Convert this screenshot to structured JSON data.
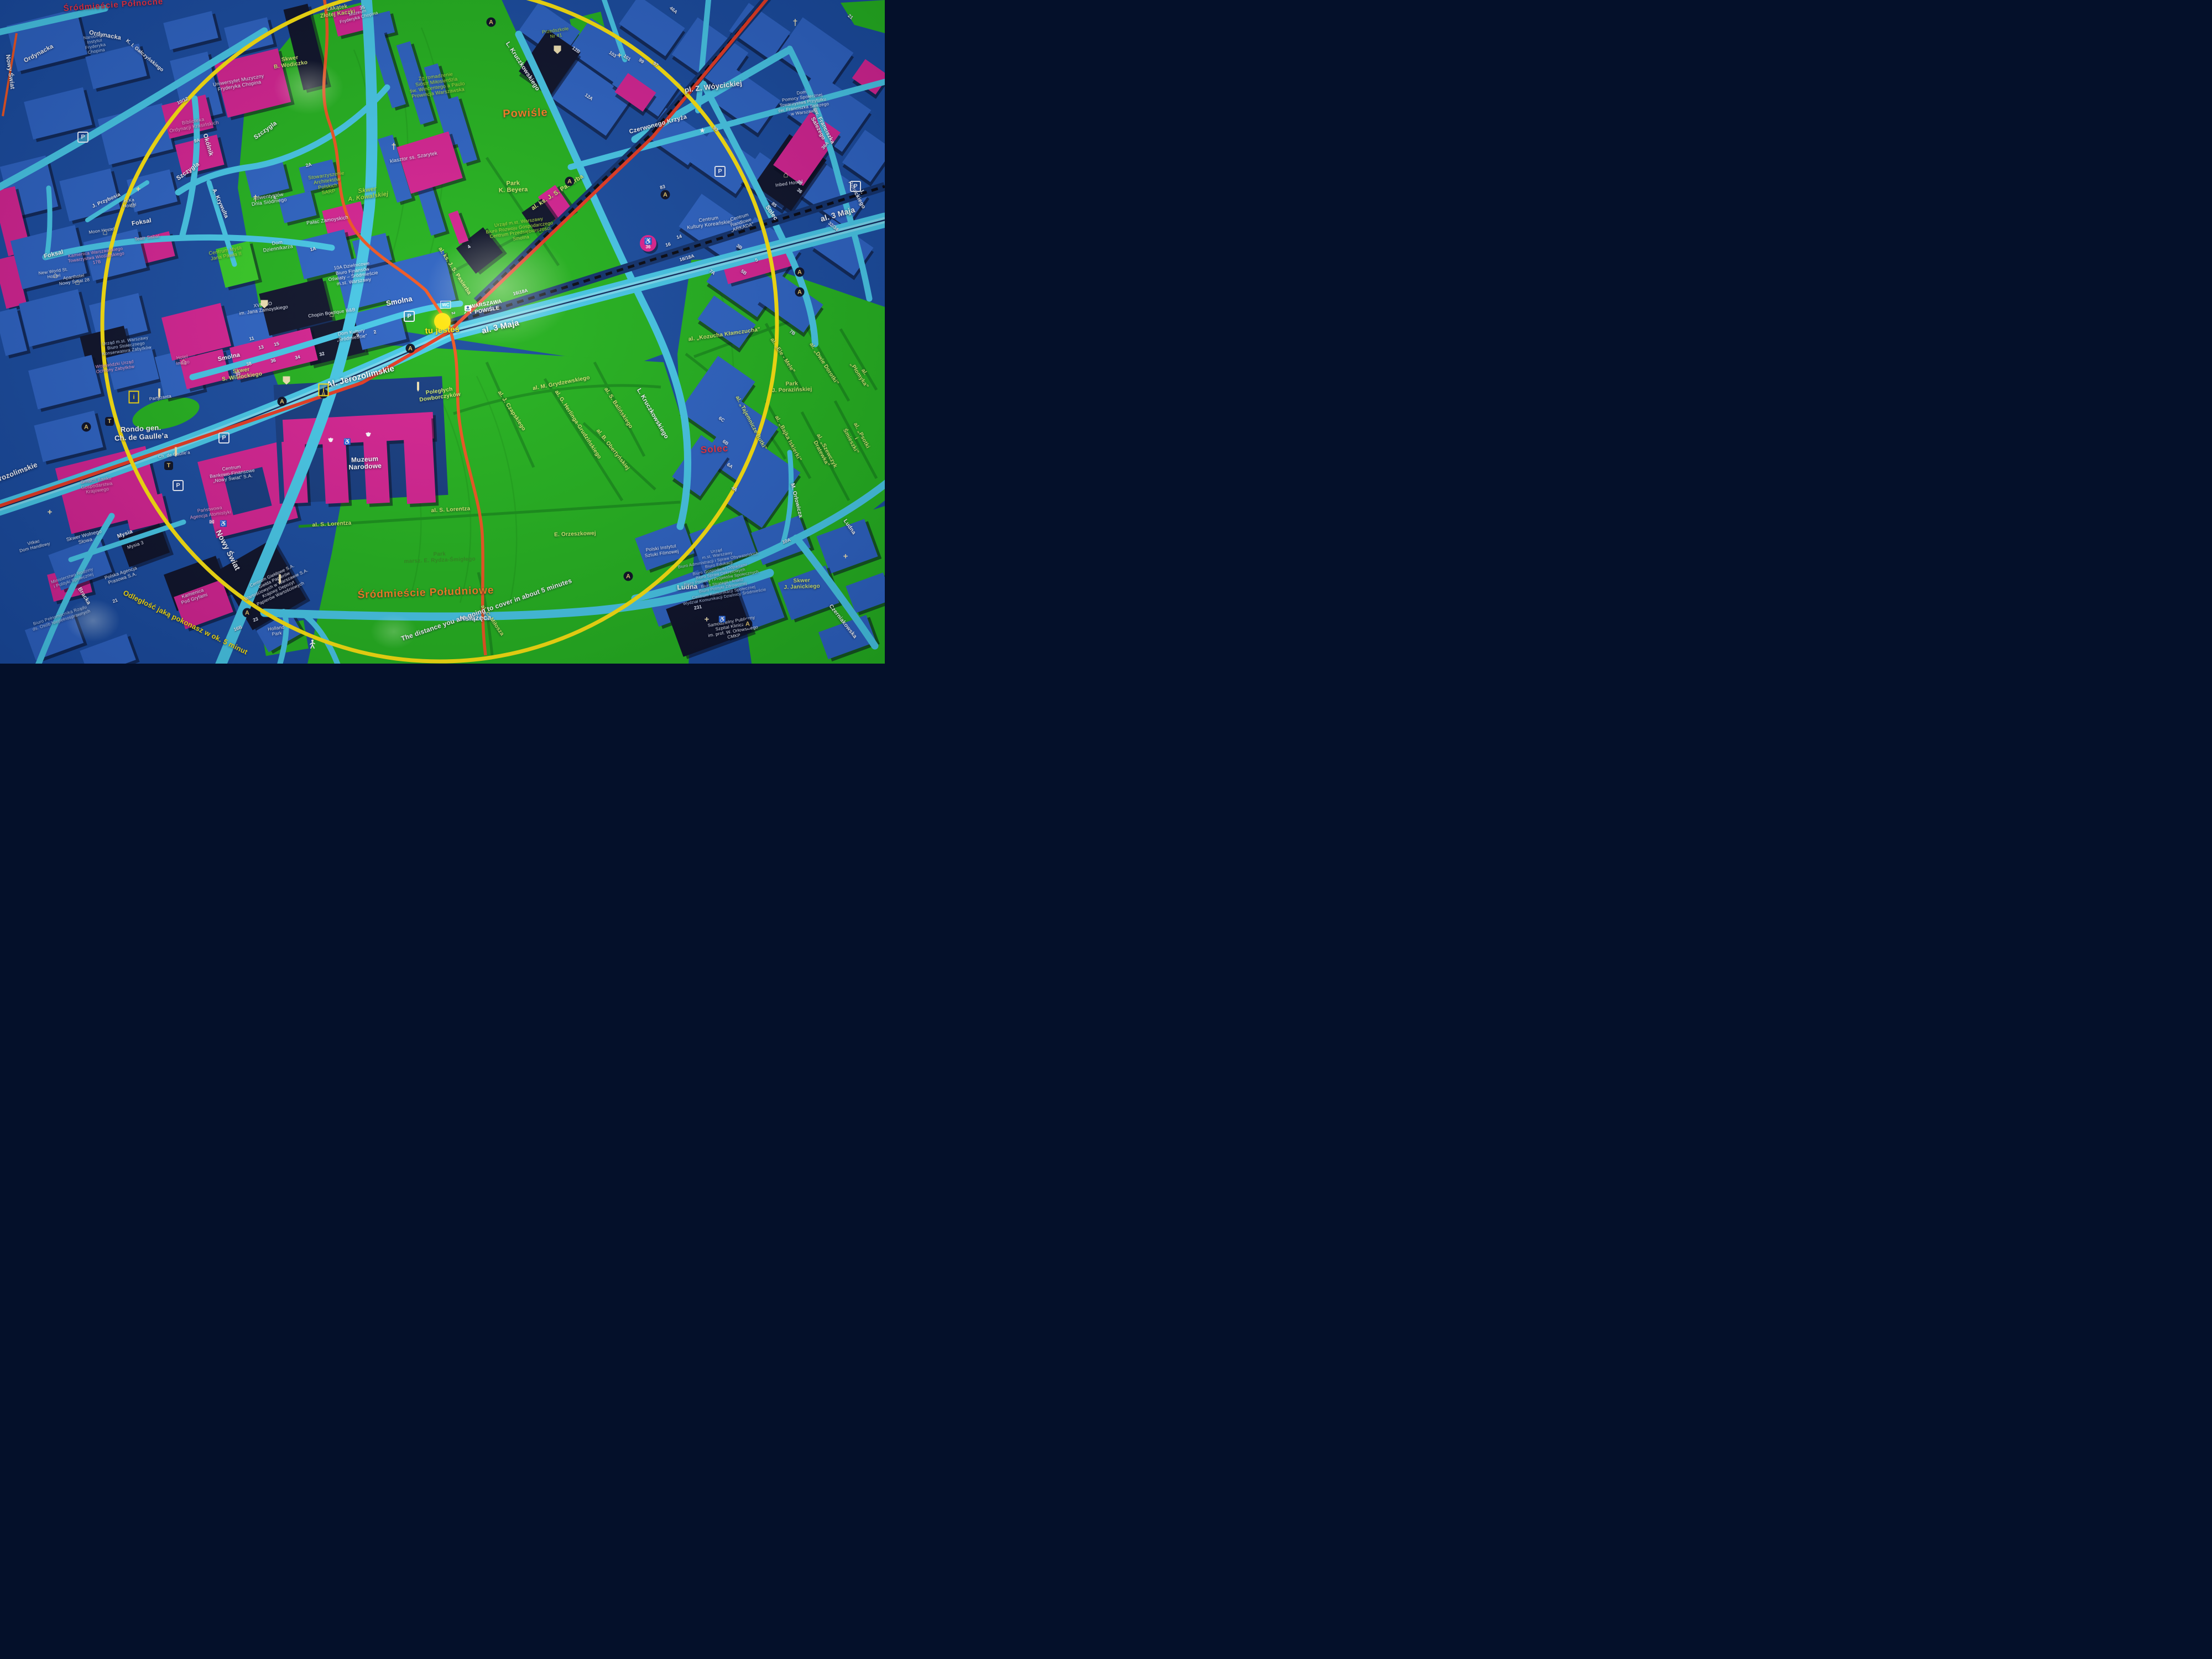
{
  "map": {
    "title": "Plan okolicy – Warszawa Śródmieście / Powiśle (tablica informacyjna)",
    "you_are_here_marker": "tu jesteś",
    "walk_minutes": "5",
    "colors": {
      "park_green": "#22b31b",
      "city_blue": "#174a9e",
      "building_blue": "#2b62c3",
      "landmark_magenta": "#d62090",
      "street_cyan": "#45c9e8",
      "route_red": "#e8391f",
      "walk_ring_yellow": "#ffe60a",
      "district_red": "#ee2e3e",
      "district_orange": "#ff7f1f"
    },
    "labels": {
      "srodmiescie_polnocne": "Śródmieście Północne",
      "powisle": "Powiśle",
      "srodmiescie_poludniowe": "Śródmieście Południowe",
      "solec_district": "Solec",
      "ordynacka_a": "Ordynacka",
      "ordynacka_b": "Ordynacka",
      "okolnik": "Okólnik",
      "szczygla_a": "Szczygla",
      "szczygla_b": "Szczygla",
      "krywulta": "A. Krywulta",
      "foksal_a": "Foksal",
      "foksal_b": "Foksal",
      "smolna_a": "Smolna",
      "smolna_b": "Smolna",
      "jerozolimskie_a": "Al. Jerozolimskie",
      "jerozolimskie_b": "Jerozolimskie",
      "trzeciego_maja_a": "al. 3 Maja",
      "trzeciego_maja_b": "al. 3 Maja",
      "nowy_swiat_a": "Nowy Świat",
      "nowy_swiat_b": "Nowy Świat",
      "mysia": "Mysia",
      "bracka": "Bracka",
      "ksiazeca": "Książęca",
      "kruczkowskiego_a": "L. Kruczkowskiego",
      "kruczkowskiego_b": "L. Kruczkowskiego",
      "czerwonego_krzyza": "Czerwonego Krzyża",
      "pl_woycickiej": "pl. Z. Wóycickiej",
      "franciszka_salezego": "św. Franciszka Salezego",
      "polockiego": "I. Połockiego",
      "solec_street": "Solec",
      "orlowicza": "M. Orłowicza",
      "ludna_a": "Ludna",
      "ludna_b": "Ludna",
      "czerniakowska": "Czerniakowska",
      "galczynskiego": "K. I. Gałczyńskiego",
      "przybosia": "J. Przybosia",
      "pasierba_a": "al. ks. J. S. Pasierba",
      "pasierba_b": "al. ks. J. S. Pasierba",
      "grydzewskiego": "al. M. Grydzewskiego",
      "czapskiego": "al. J. Czapskiego",
      "herlinga": "al. G. Herlinga-Grudzińskiego",
      "obertynskiej": "al. B. Obertyńskiej",
      "balinskiego": "al. S. Balińskiego",
      "lorentza_a": "al. S. Lorentza",
      "lorentza_b": "al. S. Lorentza",
      "milosza": "al. C. Miłosza",
      "kozucha": "al. „Kozucha Kłamczucha”",
      "ele_mele": "al. „Ele - Mele”",
      "dwie_dorotki": "al. „Dwie Dorotki”",
      "plomyka": "al. „Płomyka”",
      "tajemnicze_butki": "al. „Tajemnicze Butki”",
      "bajka_iskierki": "al. „Bajka Iskierki”",
      "szewczyk_dratewka": "al. „Szewczyk Dratewka”",
      "psotki_smieszki": "al. „Psotki i Śmieszki”",
      "park_porazinskiej": "Park\nJ. Porazińskiej",
      "park_beyera": "Park\nK. Beyera",
      "park_rydza": "Park\nmarsz. E. Rydza-Śmigłego",
      "orzeszkowej": "E. Orzeszkowej",
      "skwer_janickiego": "Skwer\nJ. Janickiego",
      "skwer_wolnego_slowa": "Skwer Wolnego\nSłowa",
      "skwer_wodiczko": "Skwer\nB. Wodiczko",
      "skwer_kowalskiej": "Skwer\nA. Kowalskiej",
      "skwer_wislockiego": "Skwer\nS. Wisłockiego",
      "zakatek": "Zakątek\nZłotej Kaczki",
      "poleglych": "Poległych\nDowborczyków",
      "univ_muzyczny": "Uniwersytet Muzyczny\nFryderyka Chopina",
      "biblioteka_krasinskich": "Biblioteka\nOrdynacji Krasińskich",
      "instytut_chopina": "Narodowy\nInstytut\nFryderyka\nChopina",
      "muzeum_chopina": "Muzeum\nFryderyka Chopina",
      "zgromadzenie": "Zg romadzenie\nSióstr Miłosierdzia\nśw. Wincentego a Paulo\nProwincja Warszawska",
      "klasztor": "klasztor ss. Szarytek",
      "sarp": "Stowarzyszenie\nArchitektów\nPolskich\nSARP",
      "palac_zamoyskich": "Pałac Zamoyskich",
      "adwentystow": "Adwentystów\nDnia Siódmego",
      "dom_dziennikarza": "Dom\nDziennikarza",
      "centrum_mysli": "Centrum Myśli\nJana Pawła II",
      "biuro_finansow": "10A Dzielnicowe\nBiuro Finansów\nOświaty – Śródmieście\nm.st. Warszawy",
      "chopin_bb": "Chopin Boutique B&B",
      "dom_kultury": "Dom Kultury\n„Śródmieście”",
      "xviii_lo": "XVIII LO\nim. Jana Zamoyskiego",
      "hotel_indigo": "Hotel\nIndigo",
      "teatr_sabat": "Teatr Sabat",
      "moon_hostel": "Moon Hostel",
      "elka_hostel": "eLKa\nHostel",
      "kamienica_wioslarskiego": "Kamienica Warszawskiego\nTowarzystwa Wioślarskiego\n17B",
      "aparthotel": "Aparthotel\nNowy Świat 28",
      "nw_hostel": "New World St.\nHostel",
      "konserwator": "Urząd m.st. Warszawy\nBiuro Stołecznego\nKonserwatora Zabytków",
      "wojewodzki": "Wojewódzki Urząd\nOchrony Zabytków",
      "rondo_degaulle": "Rondo gen.\nCh. de Gaulle’a",
      "degaulle_mon": "Ch. de Gaulle’a",
      "gmach_banku": "Gmach Banku\nGospodarstwa\nKrajowego",
      "cbf": "Centrum\nBankowo-Finansowe\n„Nowy Świat” S.A.",
      "agencja_atomistyki": "Państwowa\nAgencja Atomistyki",
      "mysia3": "Mysia 3",
      "pap": "Polska Agencja\nPrasowa S.A.",
      "ministerstwo": "Ministerstwo Rodziny\ni Polityki Społecznej",
      "pod_gryfami": "Kamienica\nPod Gryfami",
      "gieldowe": "Centrum Giełdowe S.A.\nGiełda Papierów\nWartościowych w Warszawie S.A.\nKrajowy Depozyt\nPapierów Wartościowych",
      "holland_park": "Holland\nPark",
      "vitkac": "Vitkac\nDom Handlowy",
      "pelnomocnik": "Biuro Pełnomocnika Rządu\nds. Osób Niepełnosprawnych",
      "muzeum_narodowe": "Muzeum\nNarodowe",
      "urzad_smolna": "Urząd m.st. Warszawy\nBiuro Rozwoju Gospodarczego\nCentrum Przedsiębiorczości\nSmolna",
      "station": "WARSZAWA\nPOWIŚLE",
      "tu_jestes": "tu jesteś",
      "arkada": "Centrum\nHandlowe\n„ARKADA”",
      "przedszkole41": "Przedszkole\nNr 41",
      "dom_pomocy": "Dom\nPomocy Społecznej\nTowarzystwa Przytułku\nśw. Franciszka Salezego\nw Warszawie",
      "inbed": "Inbed Hostel",
      "kultury_koreanskiej": "Centrum\nKultury Koreańskiej",
      "instytut_filmowej": "Polski Instytut\nSztuki Filmowej",
      "urzad_ludna": "Urząd\nm.st. Warszawy\nBiuro Administracji i Spraw Obywatelskich\nBiuro Edukacji\nBiuro Gospodarki Odpadami\nBiuro Spraw Dekretowych\nBiuro Pomocy i Projektów Społecznych\nBiuro Strategii i Analiz\nBiuro Polityki Zdrowotnej\nCentrum Komunikacji Społecznej\nWydział Komunikacji Dzielnicy Śródmieście",
      "szpital": "Samodzielny Publiczny\nSzpital Kliniczny\nim. prof. W. Orłowskiego\nCMKP",
      "partyzanta": "Partyzanta",
      "legend_pl": "Odległość jaką pokonasz w ok. 5 minut",
      "legend_en": "The distance you are going to cover in about 5 minutes"
    },
    "icon_glyphs": {
      "a": "A",
      "t": "T",
      "p": "P",
      "i": "i",
      "star": "★",
      "church": "†",
      "plus": "+",
      "mail": "✉",
      "wheel": "♿",
      "house": "⌂",
      "wc": "WC"
    },
    "numbers": [
      "35",
      "2A",
      "1A",
      "9A",
      "6.",
      "36",
      "34",
      "32",
      "38",
      "30",
      "16B",
      "23",
      "21",
      "83",
      "3B",
      "5B",
      "7A",
      "5",
      "16/18A",
      "16i18A",
      "12B",
      "103",
      "101",
      "99",
      "97",
      "93",
      "85",
      "36A",
      "32/34",
      "6C",
      "6B",
      "6A",
      "4A",
      "231",
      "12A",
      "7B",
      "10A",
      "14",
      "16",
      "4",
      "2",
      "9.",
      "2",
      "11",
      "15",
      "13",
      "10/12",
      "46A",
      "21",
      "36",
      "38"
    ]
  }
}
